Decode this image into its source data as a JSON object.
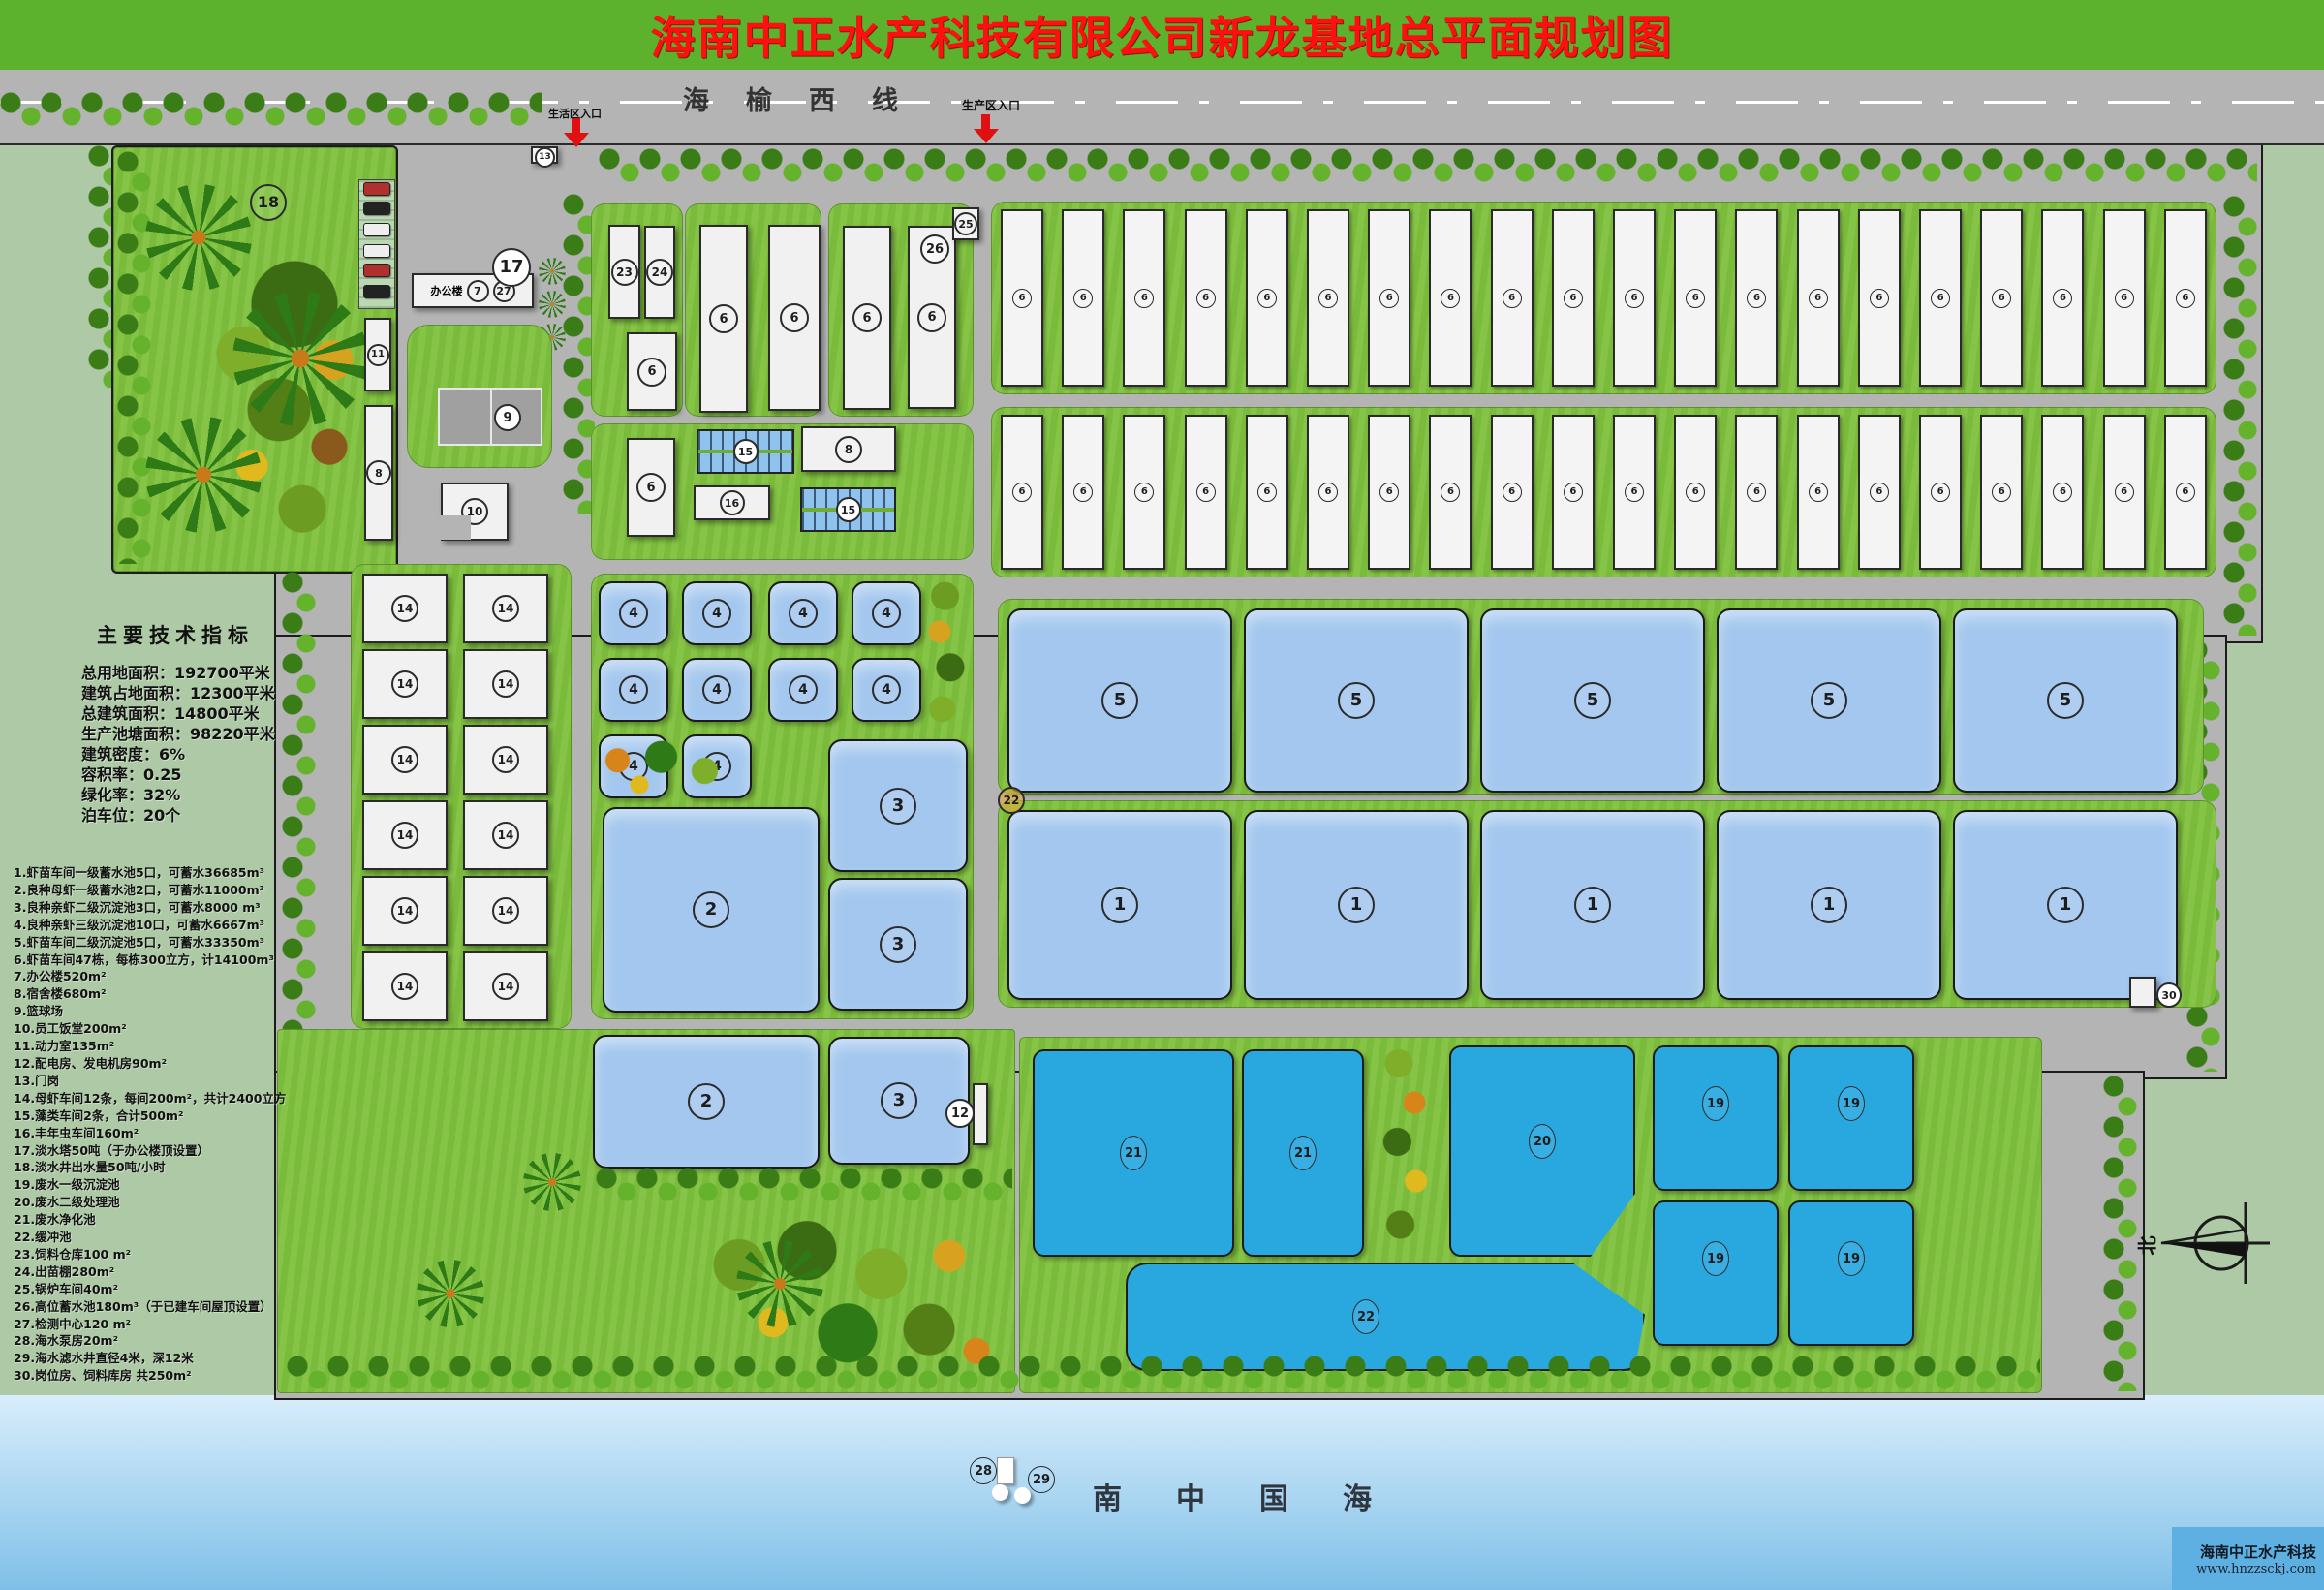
{
  "header": {
    "title": "海南中正水产科技有限公司新龙基地总平面规划图"
  },
  "road": {
    "name": "海榆西线",
    "entrance_life": "生活区入口",
    "entrance_prod": "生产区入口"
  },
  "legend": {
    "title": "主要技术指标",
    "indicators": [
      "总用地面积：192700平米",
      "建筑占地面积：12300平米",
      "总建筑面积：14800平米",
      "生产池塘面积：98220平米",
      "建筑密度：6%",
      "容积率：0.25",
      "绿化率：32%",
      "泊车位：20个"
    ],
    "items": [
      "1.虾苗车间一级蓄水池5口，可蓄水36685m³",
      "2.良种母虾一级蓄水池2口，可蓄水11000m³",
      "3.良种亲虾二级沉淀池3口，可蓄水8000 m³",
      "4.良种亲虾三级沉淀池10口，可蓄水6667m³",
      "5.虾苗车间二级沉淀池5口，可蓄水33350m³",
      "6.虾苗车间47栋，每栋300立方，计14100m³",
      "7.办公楼520m²",
      "8.宿舍楼680m²",
      "9.篮球场",
      "10.员工饭堂200m²",
      "11.动力室135m²",
      "12.配电房、发电机房90m²",
      "13.门岗",
      "14.母虾车间12条，每间200m²，共计2400立方",
      "15.藻类车间2条，合计500m²",
      "16.丰年虫车间160m²",
      "17.淡水塔50吨（于办公楼顶设置）",
      "18.淡水井出水量50吨/小时",
      "19.废水一级沉淀池",
      "20.废水二级处理池",
      "21.废水净化池",
      "22.缓冲池",
      "23.饲料仓库100 m²",
      "24.出苗棚280m²",
      "25.锅炉车间40m²",
      "26.高位蓄水池180m³（于已建车间屋顶设置）",
      "27.检测中心120 m²",
      "28.海水泵房20m²",
      "29.海水滤水井直径4米，深12米",
      "30.岗位房、饲料库房 共250m²"
    ]
  },
  "office": {
    "name": "办公楼"
  },
  "marks": {
    "m1": "1",
    "m2": "2",
    "m3": "3",
    "m4": "4",
    "m5": "5",
    "m6": "6",
    "m7": "7",
    "m8": "8",
    "m9": "9",
    "m10": "10",
    "m11": "11",
    "m12": "12",
    "m13": "13",
    "m14": "14",
    "m15": "15",
    "m16": "16",
    "m17": "17",
    "m18": "18",
    "m19": "19",
    "m20": "20",
    "m21": "21",
    "m22": "22",
    "m23": "23",
    "m24": "24",
    "m25": "25",
    "m26": "26",
    "m27": "27",
    "m28": "28",
    "m29": "29",
    "m30": "30"
  },
  "repeats": {
    "stripes1": [
      "6",
      "6",
      "6",
      "6",
      "6",
      "6",
      "6",
      "6",
      "6",
      "6",
      "6",
      "6",
      "6",
      "6",
      "6",
      "6",
      "6",
      "6",
      "6",
      "6"
    ],
    "stripes2": [
      "6",
      "6",
      "6",
      "6",
      "6",
      "6",
      "6",
      "6",
      "6",
      "6",
      "6",
      "6",
      "6",
      "6",
      "6",
      "6",
      "6",
      "6",
      "6",
      "6"
    ],
    "sheds14": [
      "14",
      "14",
      "14",
      "14",
      "14",
      "14",
      "14",
      "14",
      "14",
      "14",
      "14",
      "14"
    ],
    "ponds4a": [
      "4",
      "4",
      "4",
      "4",
      "4",
      "4"
    ],
    "ponds4b": [
      "4",
      "4",
      "4",
      "4"
    ],
    "ponds5": [
      "5",
      "5",
      "5",
      "5",
      "5"
    ],
    "ponds1": [
      "1",
      "1",
      "1",
      "1",
      "1"
    ],
    "ponds19": [
      "19",
      "19",
      "19",
      "19"
    ]
  },
  "sea": {
    "label": "南中国海"
  },
  "logo": {
    "name": "海南中正水产科技",
    "url": "www.hnzzsckj.com"
  },
  "compass": {
    "north": "北"
  },
  "colors": {
    "header_green": "#5cb22d",
    "title_red": "#ff0f0f",
    "road_gray": "#b4b4b4",
    "grass": "#7fc13d",
    "outer_sage": "#adc9a5",
    "pond_light": "#a3c7ee",
    "pond_cyan": "#29a8e0",
    "sea_top": "#d9edfb",
    "sea_bottom": "#7fc0e8"
  }
}
